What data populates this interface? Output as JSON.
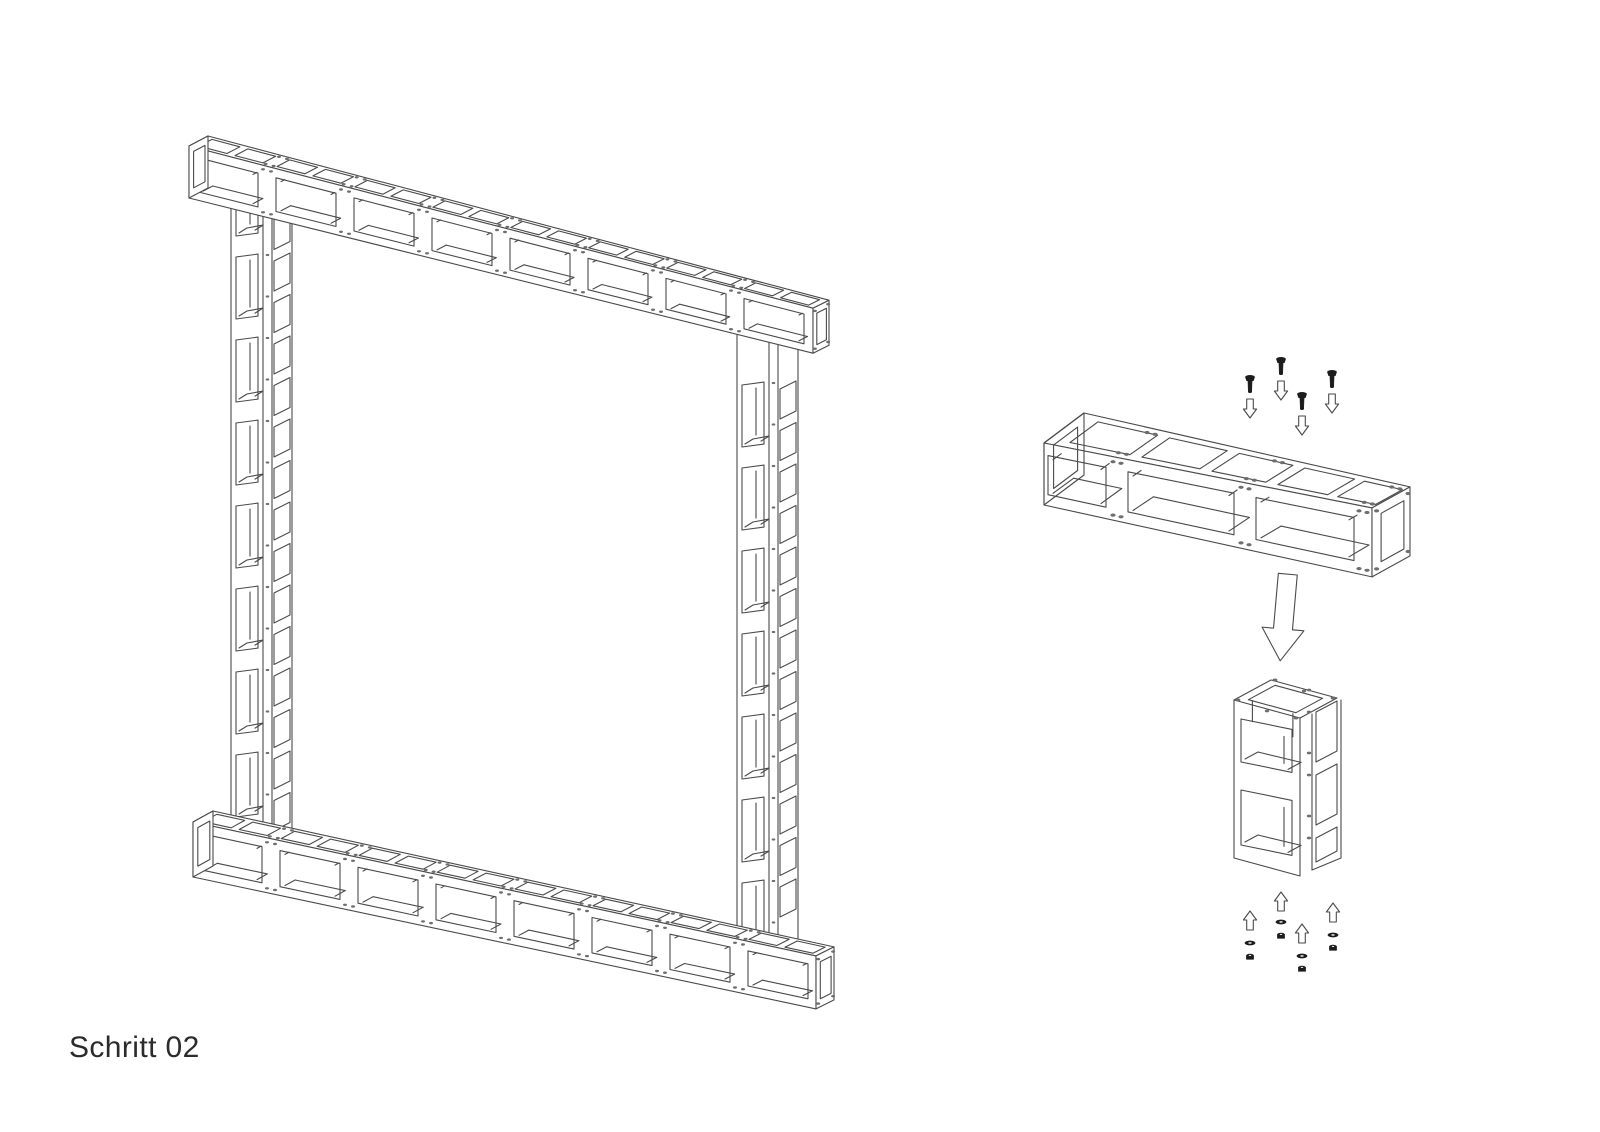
{
  "step_label": "Schritt 02",
  "style": {
    "background": "#ffffff",
    "line_color": "#4a4a4a",
    "dark_color": "#1c1c1c",
    "dot_color": "#6e6e6e"
  },
  "frame_view": {
    "beams": [
      {
        "id": "top-beam",
        "x": 189,
        "y": 146,
        "length": 624,
        "slope": 0.26,
        "height": [
          52,
          45
        ],
        "depth": [
          [
            19,
            -10
          ],
          [
            16,
            -8
          ]
        ],
        "modules": 8,
        "module_length": 78,
        "opening_band": [
          0.18,
          0.84
        ],
        "square_band": [
          0.16,
          0.84
        ],
        "dot_r": 2.0
      },
      {
        "id": "bottom-beam",
        "x": 193,
        "y": 822,
        "length": 623,
        "slope": 0.215,
        "height": [
          55,
          53
        ],
        "depth": [
          [
            20,
            -11
          ],
          [
            18,
            -9
          ]
        ],
        "modules": 8,
        "module_length": 78,
        "opening_band": [
          0.18,
          0.84
        ],
        "square_band": [
          0.16,
          0.84
        ],
        "dot_r": 2.0
      }
    ],
    "columns": [
      {
        "id": "left-column",
        "x": 231,
        "y_top": 190,
        "y_bottom": 846,
        "front_width": 32,
        "flange_width": 9,
        "side_width": 20,
        "front_slope": -0.13,
        "side_slant": 8,
        "front_opening_tops": [
          174,
          257,
          340,
          423,
          506,
          589,
          672,
          755
        ],
        "front_opening_height": 62,
        "side_start": 178,
        "side_step": 41.5,
        "side_count": 16,
        "side_height": 30,
        "dot_start": 172,
        "dot_step": 41.5,
        "dot_count": 17
      },
      {
        "id": "right-column",
        "x": 737,
        "y_top": 326,
        "y_bottom": 958,
        "front_width": 32,
        "flange_width": 9,
        "side_width": 20,
        "front_slope": -0.13,
        "side_slant": 8,
        "front_opening_tops": [
          385,
          468,
          551,
          634,
          717,
          800,
          883
        ],
        "front_opening_height": 62,
        "side_start": 389,
        "side_step": 41.5,
        "side_count": 13,
        "side_height": 30,
        "dot_start": 383,
        "dot_step": 41.5,
        "dot_count": 14
      }
    ]
  },
  "detail_view": {
    "beam": {
      "x": 1044,
      "y": 443,
      "length": 328,
      "slope": 0.198,
      "height": [
        62,
        69
      ],
      "depth": [
        [
          40,
          -30
        ],
        [
          38,
          -21
        ]
      ],
      "front_openings": [
        [
          4,
          62
        ],
        [
          84,
          190
        ],
        [
          212,
          310
        ]
      ],
      "top_squares": [
        [
          20,
          80
        ],
        [
          92,
          150
        ],
        [
          162,
          216
        ],
        [
          228,
          278
        ],
        [
          288,
          326
        ]
      ],
      "joints": [
        73,
        201,
        319
      ],
      "opening_band": [
        0.19,
        0.82
      ],
      "square_band": [
        0.15,
        0.85
      ],
      "dot_r": 2.6,
      "open_start": true
    },
    "column": {
      "x": 1234,
      "top_y": 700,
      "u": [
        66,
        18
      ],
      "d": [
        37,
        -20
      ],
      "bottom_y": 858,
      "front_width": 66,
      "flange_width": 8,
      "side_width": 33,
      "front_slope": 0.2,
      "side_slant": 11,
      "front_openings": [
        [
          719,
          43
        ],
        [
          790,
          55
        ]
      ],
      "side_openings": [
        [
          712,
          50
        ],
        [
          775,
          50
        ],
        [
          838,
          24
        ]
      ],
      "flange_dots": [
        690,
        712,
        753,
        775,
        816,
        838
      ]
    },
    "screws": [
      [
        1250,
        384
      ],
      [
        1281,
        366
      ],
      [
        1302,
        401
      ],
      [
        1332,
        379
      ]
    ],
    "screw_arrows": [
      [
        1250,
        399
      ],
      [
        1281,
        381
      ],
      [
        1302,
        416
      ],
      [
        1332,
        394
      ]
    ],
    "insertion_arrow": {
      "cx": 1284,
      "top": 574,
      "shaft_bottom": 629,
      "tip": 661,
      "lean_deg": 5
    },
    "fastener_sets": [
      {
        "x": 1250,
        "arrow_top": 911,
        "washer_y": 943,
        "nut_y": 957
      },
      {
        "x": 1281,
        "arrow_top": 892,
        "washer_y": 922,
        "nut_y": 936
      },
      {
        "x": 1302,
        "arrow_top": 924,
        "washer_y": 956,
        "nut_y": 969
      },
      {
        "x": 1333,
        "arrow_top": 903,
        "washer_y": 935,
        "nut_y": 948
      }
    ]
  }
}
